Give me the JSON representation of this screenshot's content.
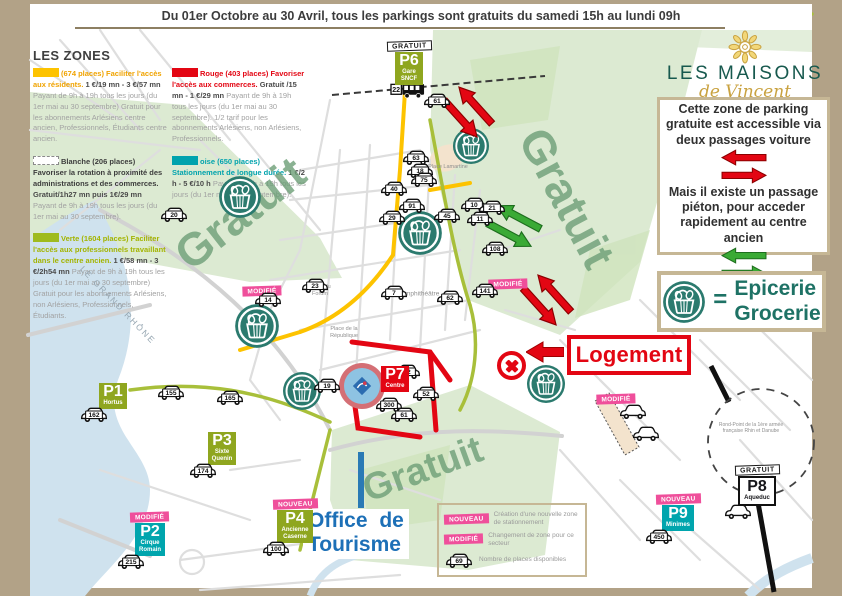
{
  "banner": {
    "text": "Du 01er Octobre au 30 Avril, tous les parkings sont gratuits du samedi 15h au lundi 09h"
  },
  "logo": {
    "name": "LES MAISONS",
    "sub": "de Vincent"
  },
  "zones_legend": {
    "title": "LES ZONES",
    "columns": [
      [
        {
          "key": "jaune",
          "swatch": "#fdc300",
          "dashed": false,
          "heading": "(674 places) Faciliter l'accès aux résidents.",
          "heading_color": "#f0a300",
          "price": "1 €/19 mn  -  3 €/57 mn",
          "body": "Payant de 9h à 19h tous les jours (du 1er mai au 30 septembre) Gratuit pour les abonnements Arlésiens centre ancien, Professionnels, Étudiants centre ancien."
        },
        {
          "key": "blanche",
          "swatch": "#ffffff",
          "dashed": true,
          "heading": "Blanche (206 places) Favoriser la rotation à proximité des administrations et des commerces.",
          "heading_color": "#3d3d3d",
          "price": "Gratuit/1h27 mn puis 1€/29 mn",
          "body": "Payant de 9h à 19h tous les jours (du 1er mai au 30 septembre)."
        },
        {
          "key": "verte",
          "swatch": "#9fbb1e",
          "dashed": false,
          "heading": "Verte (1604 places) Faciliter l'accès aux professionnels travaillant dans le centre ancien.",
          "heading_color": "#a3b400",
          "price": "1 €/58 mn  -  3 €/2h54 mn",
          "body": "Payant de 9h à 19h tous les jours (du 1er mai au 30 septembre) Gratuit pour les abonnements Arlésiens, non Arlésiens, Professionnels, Étudiants."
        }
      ],
      [
        {
          "key": "rouge",
          "swatch": "#e30613",
          "dashed": false,
          "heading": "Rouge (403 places) Favoriser l'accès aux commerces.",
          "heading_color": "#e30613",
          "price": "Gratuit /15 mn  -  1 €/29 mn",
          "body": "Payant de 9h à 19h tous les jours (du 1er mai au 30 septembre). 1/2 tarif pour les abonnements Arlésiens, non Arlésiens, Professionnels."
        },
        {
          "key": "turquoise",
          "swatch": "#00a3ad",
          "dashed": false,
          "heading": "oise (650 places) Stationnement de longue durée.",
          "heading_color": "#00a3ad",
          "price": "1 €/2 h  -  5 €/10 h",
          "body": "Payant de 9h à 19h tous les jours (du 1er mai au 30 septembre)."
        }
      ]
    ]
  },
  "info_box": {
    "para1": "Cette zone de parking gratuite est accessible via deux passages voiture",
    "para2": "Mais il existe un passage piéton, pour acceder rapidement au centre ancien"
  },
  "epicerie": {
    "line1": "Epicerie",
    "line2": "Grocerie"
  },
  "logement": {
    "label": "Logement"
  },
  "office": {
    "line1": "Office de",
    "line2": "Tourisme"
  },
  "bus": {
    "label": "22",
    "x": 390,
    "y": 82
  },
  "map_legend": {
    "items": [
      {
        "badge": "NOUVEAU",
        "type": "pink",
        "text": "Création d'une nouvelle zone de stationnement"
      },
      {
        "badge": "MODIFIÉ",
        "type": "pink",
        "text": "Changement de zone pour ce secteur"
      },
      {
        "badge": "69",
        "type": "car",
        "text": "Nombre de places disponibles"
      }
    ]
  },
  "parkings": [
    {
      "id": "P1",
      "lines": [
        "Hortus"
      ],
      "style": "green",
      "badge": null,
      "badge_style": null,
      "count": "162",
      "x": 113,
      "y": 383
    },
    {
      "id": "P2",
      "lines": [
        "Cirque",
        "Romain"
      ],
      "style": "teal",
      "badge": "MODIFIÉ",
      "badge_style": "pink",
      "count": "215",
      "x": 150,
      "y": 505
    },
    {
      "id": "P3",
      "lines": [
        "Sixte",
        "Quenin"
      ],
      "style": "green",
      "badge": null,
      "badge_style": null,
      "count": "174",
      "x": 222,
      "y": 432
    },
    {
      "id": "P4",
      "lines": [
        "Ancienne",
        "Caserne"
      ],
      "style": "green",
      "badge": "NOUVEAU",
      "badge_style": "pink",
      "count": "100",
      "x": 295,
      "y": 492
    },
    {
      "id": "P6",
      "lines": [
        "Gare",
        "SNCF"
      ],
      "style": "green",
      "badge": "GRATUIT",
      "badge_style": "black",
      "count": null,
      "x": 409,
      "y": 34
    },
    {
      "id": "P7",
      "lines": [
        "Centre"
      ],
      "style": "red",
      "badge": null,
      "badge_style": null,
      "count": null,
      "x": 395,
      "y": 366
    },
    {
      "id": "P8",
      "lines": [
        "Aqueduc"
      ],
      "style": "white",
      "badge": "GRATUIT",
      "badge_style": "black",
      "count": "",
      "x": 757,
      "y": 458
    },
    {
      "id": "P9",
      "lines": [
        "Minimes"
      ],
      "style": "teal",
      "badge": "NOUVEAU",
      "badge_style": "pink",
      "count": "450",
      "x": 678,
      "y": 487
    }
  ],
  "car_badges": [
    {
      "n": "155",
      "x": 171,
      "y": 393
    },
    {
      "n": "165",
      "x": 230,
      "y": 398
    },
    {
      "n": "20",
      "x": 174,
      "y": 215
    },
    {
      "n": "61",
      "x": 437,
      "y": 101
    },
    {
      "n": "40",
      "x": 394,
      "y": 189
    },
    {
      "n": "91",
      "x": 412,
      "y": 206
    },
    {
      "n": "29",
      "x": 392,
      "y": 218
    },
    {
      "n": "63",
      "x": 416,
      "y": 158
    },
    {
      "n": "18",
      "x": 420,
      "y": 171
    },
    {
      "n": "75",
      "x": 424,
      "y": 180
    },
    {
      "n": "10",
      "x": 474,
      "y": 205
    },
    {
      "n": "21",
      "x": 492,
      "y": 208
    },
    {
      "n": "45",
      "x": 447,
      "y": 216
    },
    {
      "n": "11",
      "x": 480,
      "y": 219
    },
    {
      "n": "108",
      "x": 495,
      "y": 249
    },
    {
      "n": "141",
      "x": 485,
      "y": 291
    },
    {
      "n": "7",
      "x": 394,
      "y": 293
    },
    {
      "n": "62",
      "x": 450,
      "y": 298
    },
    {
      "n": "23",
      "x": 315,
      "y": 286
    },
    {
      "n": "14",
      "x": 268,
      "y": 300
    },
    {
      "n": "19",
      "x": 327,
      "y": 386
    },
    {
      "n": "42",
      "x": 407,
      "y": 372
    },
    {
      "n": "52",
      "x": 426,
      "y": 394
    },
    {
      "n": "300",
      "x": 389,
      "y": 405
    },
    {
      "n": "61",
      "x": 404,
      "y": 415
    },
    {
      "n": "",
      "x": 633,
      "y": 412
    },
    {
      "n": "",
      "x": 646,
      "y": 434
    }
  ],
  "baskets": [
    {
      "x": 240,
      "y": 197,
      "d": 44
    },
    {
      "x": 420,
      "y": 233,
      "d": 46
    },
    {
      "x": 257,
      "y": 326,
      "d": 46
    },
    {
      "x": 302,
      "y": 391,
      "d": 40
    },
    {
      "x": 471,
      "y": 146,
      "d": 38
    },
    {
      "x": 546,
      "y": 384,
      "d": 40
    }
  ],
  "standalone_badges": [
    {
      "t": "MODIFIÉ",
      "x": 262,
      "y": 288
    },
    {
      "t": "MODIFIÉ",
      "x": 508,
      "y": 281
    },
    {
      "t": "MODIFIÉ",
      "x": 616,
      "y": 396
    }
  ],
  "gratuit_labels": [
    {
      "text": "Gratuit",
      "x": 240,
      "y": 213,
      "rot": -38,
      "size": 46
    },
    {
      "text": "Gratuit",
      "x": 567,
      "y": 198,
      "rot": 62,
      "size": 46
    },
    {
      "text": "Gratuit",
      "x": 423,
      "y": 470,
      "rot": -20,
      "size": 38
    }
  ],
  "street_labels": [
    {
      "text": "LE GRAND RHÔNE",
      "x": 118,
      "y": 305,
      "rot": 46,
      "size": 8.5,
      "ls": 2,
      "color": "#97a7b2",
      "w": 0
    },
    {
      "text": "Place Lamartine",
      "x": 448,
      "y": 167,
      "rot": 0,
      "size": 5.5,
      "ls": 0,
      "color": "#8f8f8f",
      "w": 0
    },
    {
      "text": "Amphithéâtre",
      "x": 420,
      "y": 294,
      "rot": 0,
      "size": 6.5,
      "ls": 0,
      "color": "#8f8f8f",
      "w": 0
    },
    {
      "text": "Place du Forum",
      "x": 320,
      "y": 291,
      "rot": 0,
      "size": 5.5,
      "ls": 0,
      "color": "#8f8f8f",
      "w": 34
    },
    {
      "text": "Place de la République",
      "x": 344,
      "y": 333,
      "rot": 0,
      "size": 5.5,
      "ls": 0,
      "color": "#8f8f8f",
      "w": 40
    },
    {
      "text": "Rond-Point de la 1ère armée française Rhin et Danube",
      "x": 751,
      "y": 428,
      "rot": 0,
      "size": 5,
      "ls": 0,
      "color": "#8f8f8f",
      "w": 66
    }
  ],
  "arrow_pairs": [
    {
      "color": "red",
      "x": 468,
      "y": 112,
      "rot": 48,
      "w": 52
    },
    {
      "color": "red",
      "x": 547,
      "y": 300,
      "rot": 48,
      "w": 52
    },
    {
      "color": "green",
      "x": 514,
      "y": 226,
      "rot": 28,
      "w": 52
    }
  ],
  "colors": {
    "frame_tan": "#b2a287",
    "box_border_tan": "#c6b795",
    "red": "#e30613",
    "pink_badge": "#ef4f9b",
    "teal_parking": "#00a5ad",
    "green_parking": "#8fa61f",
    "basket_teal": "#2b7a6e",
    "epicerie_teal": "#1e7265",
    "office_blue": "#1d70b7",
    "logo_teal": "#17594e",
    "logo_gold": "#c9a240",
    "gratuit_green": "#6d9f77",
    "park_green": "#dcead2",
    "river_blue": "#cfe2ee",
    "yellow_zone": "#fdc300"
  }
}
